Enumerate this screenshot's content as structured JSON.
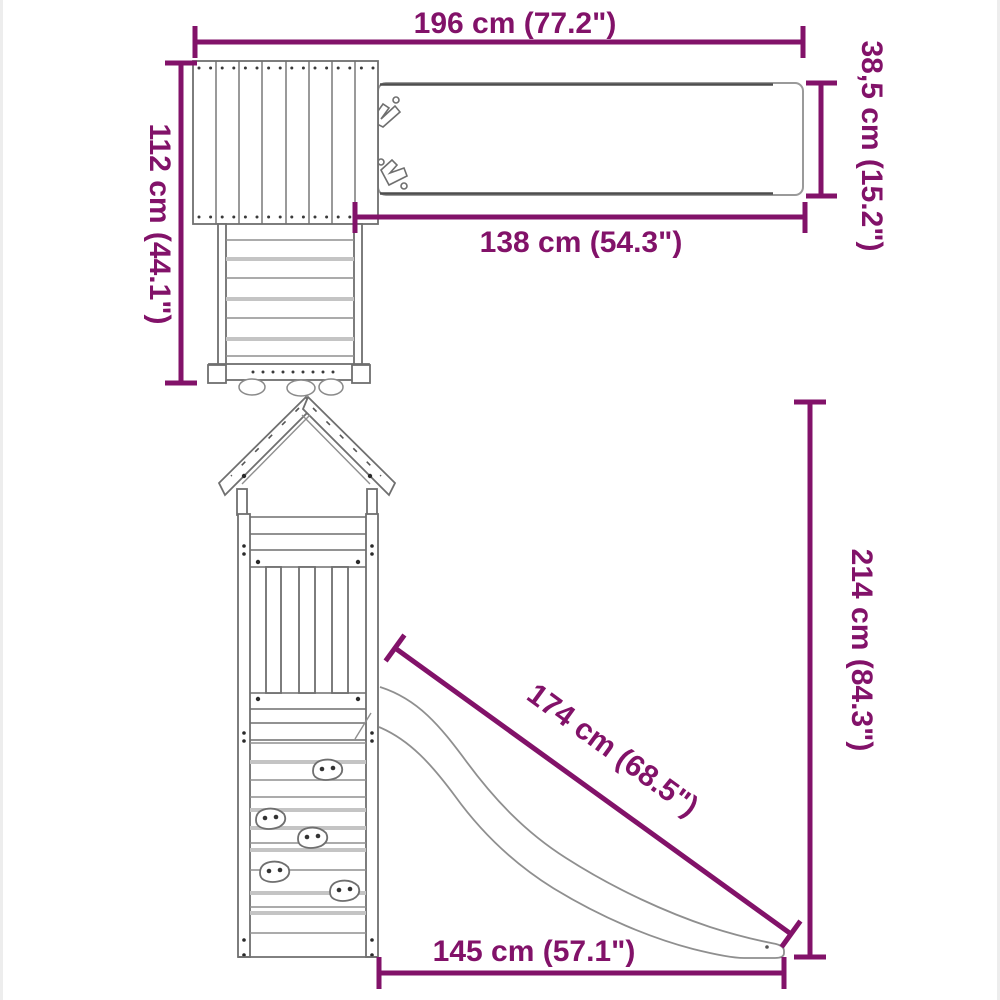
{
  "diagram": {
    "colors": {
      "accent": "#821269",
      "drawing_line": "#6f6f6f",
      "plank_shadow": "#c4c4c4",
      "background": "#ffffff"
    },
    "dimensions": {
      "top_width": "196 cm (77.2\")",
      "beam_height": "38,5 cm (15.2\")",
      "tower_depth": "112 cm (44.1\")",
      "beam_length": "138 cm (54.3\")",
      "total_height": "214 cm (84.3\")",
      "slide_length": "174 cm (68.5\")",
      "base_width": "145 cm (57.1\")"
    }
  }
}
